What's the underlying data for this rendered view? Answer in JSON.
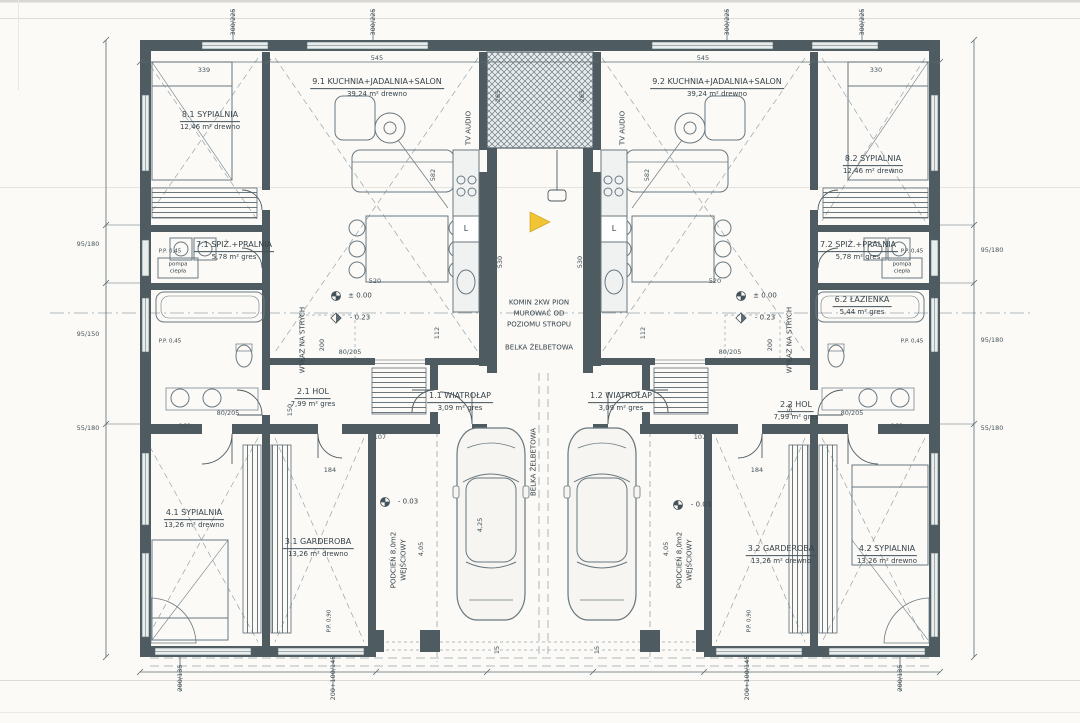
{
  "drawing": {
    "type": "scanned architectural floor plan - twin house ground floor",
    "language": "pl"
  },
  "rooms": {
    "r11": {
      "title": "1.1 WIATROŁAP",
      "sub": "3,09 m² gres"
    },
    "r12": {
      "title": "1.2 WIATROŁAP",
      "sub": "3,09 m² gres"
    },
    "r21": {
      "title": "2.1 HOL",
      "sub": "7,99 m² gres"
    },
    "r22": {
      "title": "2.2 HOL",
      "sub": "7,99 m² gres"
    },
    "r31": {
      "title": "3.1 GARDEROBA",
      "sub": "13,26 m² drewno"
    },
    "r32": {
      "title": "3.2 GARDEROBA",
      "sub": "13,26 m² drewno"
    },
    "r41": {
      "title": "4.1 SYPIALNIA",
      "sub": "13,26 m² drewno"
    },
    "r42": {
      "title": "4.2 SYPIALNIA",
      "sub": "13,26 m² drewno"
    },
    "r62": {
      "title": "6.2 ŁAZIENKA",
      "sub": "5,44 m² gres"
    },
    "r71": {
      "title": "7.1 SPIŻ.+PRALNIA",
      "sub": "5,78 m² gres"
    },
    "r72": {
      "title": "7.2 SPIŻ.+PRALNIA",
      "sub": "5,78 m² gres"
    },
    "r81": {
      "title": "8.1 SYPIALNIA",
      "sub": "12,46 m² drewno"
    },
    "r82": {
      "title": "8.2 SYPIALNIA",
      "sub": "12,46 m² drewno"
    },
    "r91": {
      "title": "9.1 KUCHNIA+JADALNIA+SALON",
      "sub": "39,24 m² drewno"
    },
    "r92": {
      "title": "9.2 KUCHNIA+JADALNIA+SALON",
      "sub": "39,24 m² drewno"
    }
  },
  "porch": {
    "line1": "PODCIEŃ 8,0m2",
    "line2": "WEJŚCIOWY",
    "width_dim": "4,05"
  },
  "annotations": {
    "chimney_note": [
      "KOMIN 2KW PION",
      "MUROWAĆ OD",
      "POZIOMU STROPU"
    ],
    "beam": "BELKA ŻELBETOWA",
    "attic_hatch": "WYŁAZ NA STRYCH",
    "tv": "TV AUDIO",
    "heat_pump": [
      "pompa",
      "ciepła"
    ],
    "fridge_mark": "L",
    "level_zero": "± 0.00",
    "level_minus023": "- 0.23",
    "level_minus003": "- 0.03",
    "sill_045": "P.P. 0,45",
    "sill_090": "P.P. 0,90",
    "car_length": "4,25"
  },
  "dimensions": {
    "top": [
      "339",
      "545",
      "545",
      "330"
    ],
    "top_windows": "300/225",
    "shaft_width": "265",
    "shaft_len": "530",
    "salon_depth": "582",
    "table_span": "520",
    "hol_span": "200",
    "d162": "162",
    "d184": "184",
    "d107": "107",
    "d112": "112",
    "d150": "150",
    "d15": "15",
    "door_80": "80/205",
    "edge_95_180": "95/180",
    "edge_95_150": "95/150",
    "edge_55_180": "55/180",
    "bottom_200_135": "200/135",
    "bottom_200_100": "200+100/145"
  },
  "colors": {
    "ink": "#44525a",
    "paper": "#fbfaf7",
    "accent_marker": "#f0c433"
  }
}
